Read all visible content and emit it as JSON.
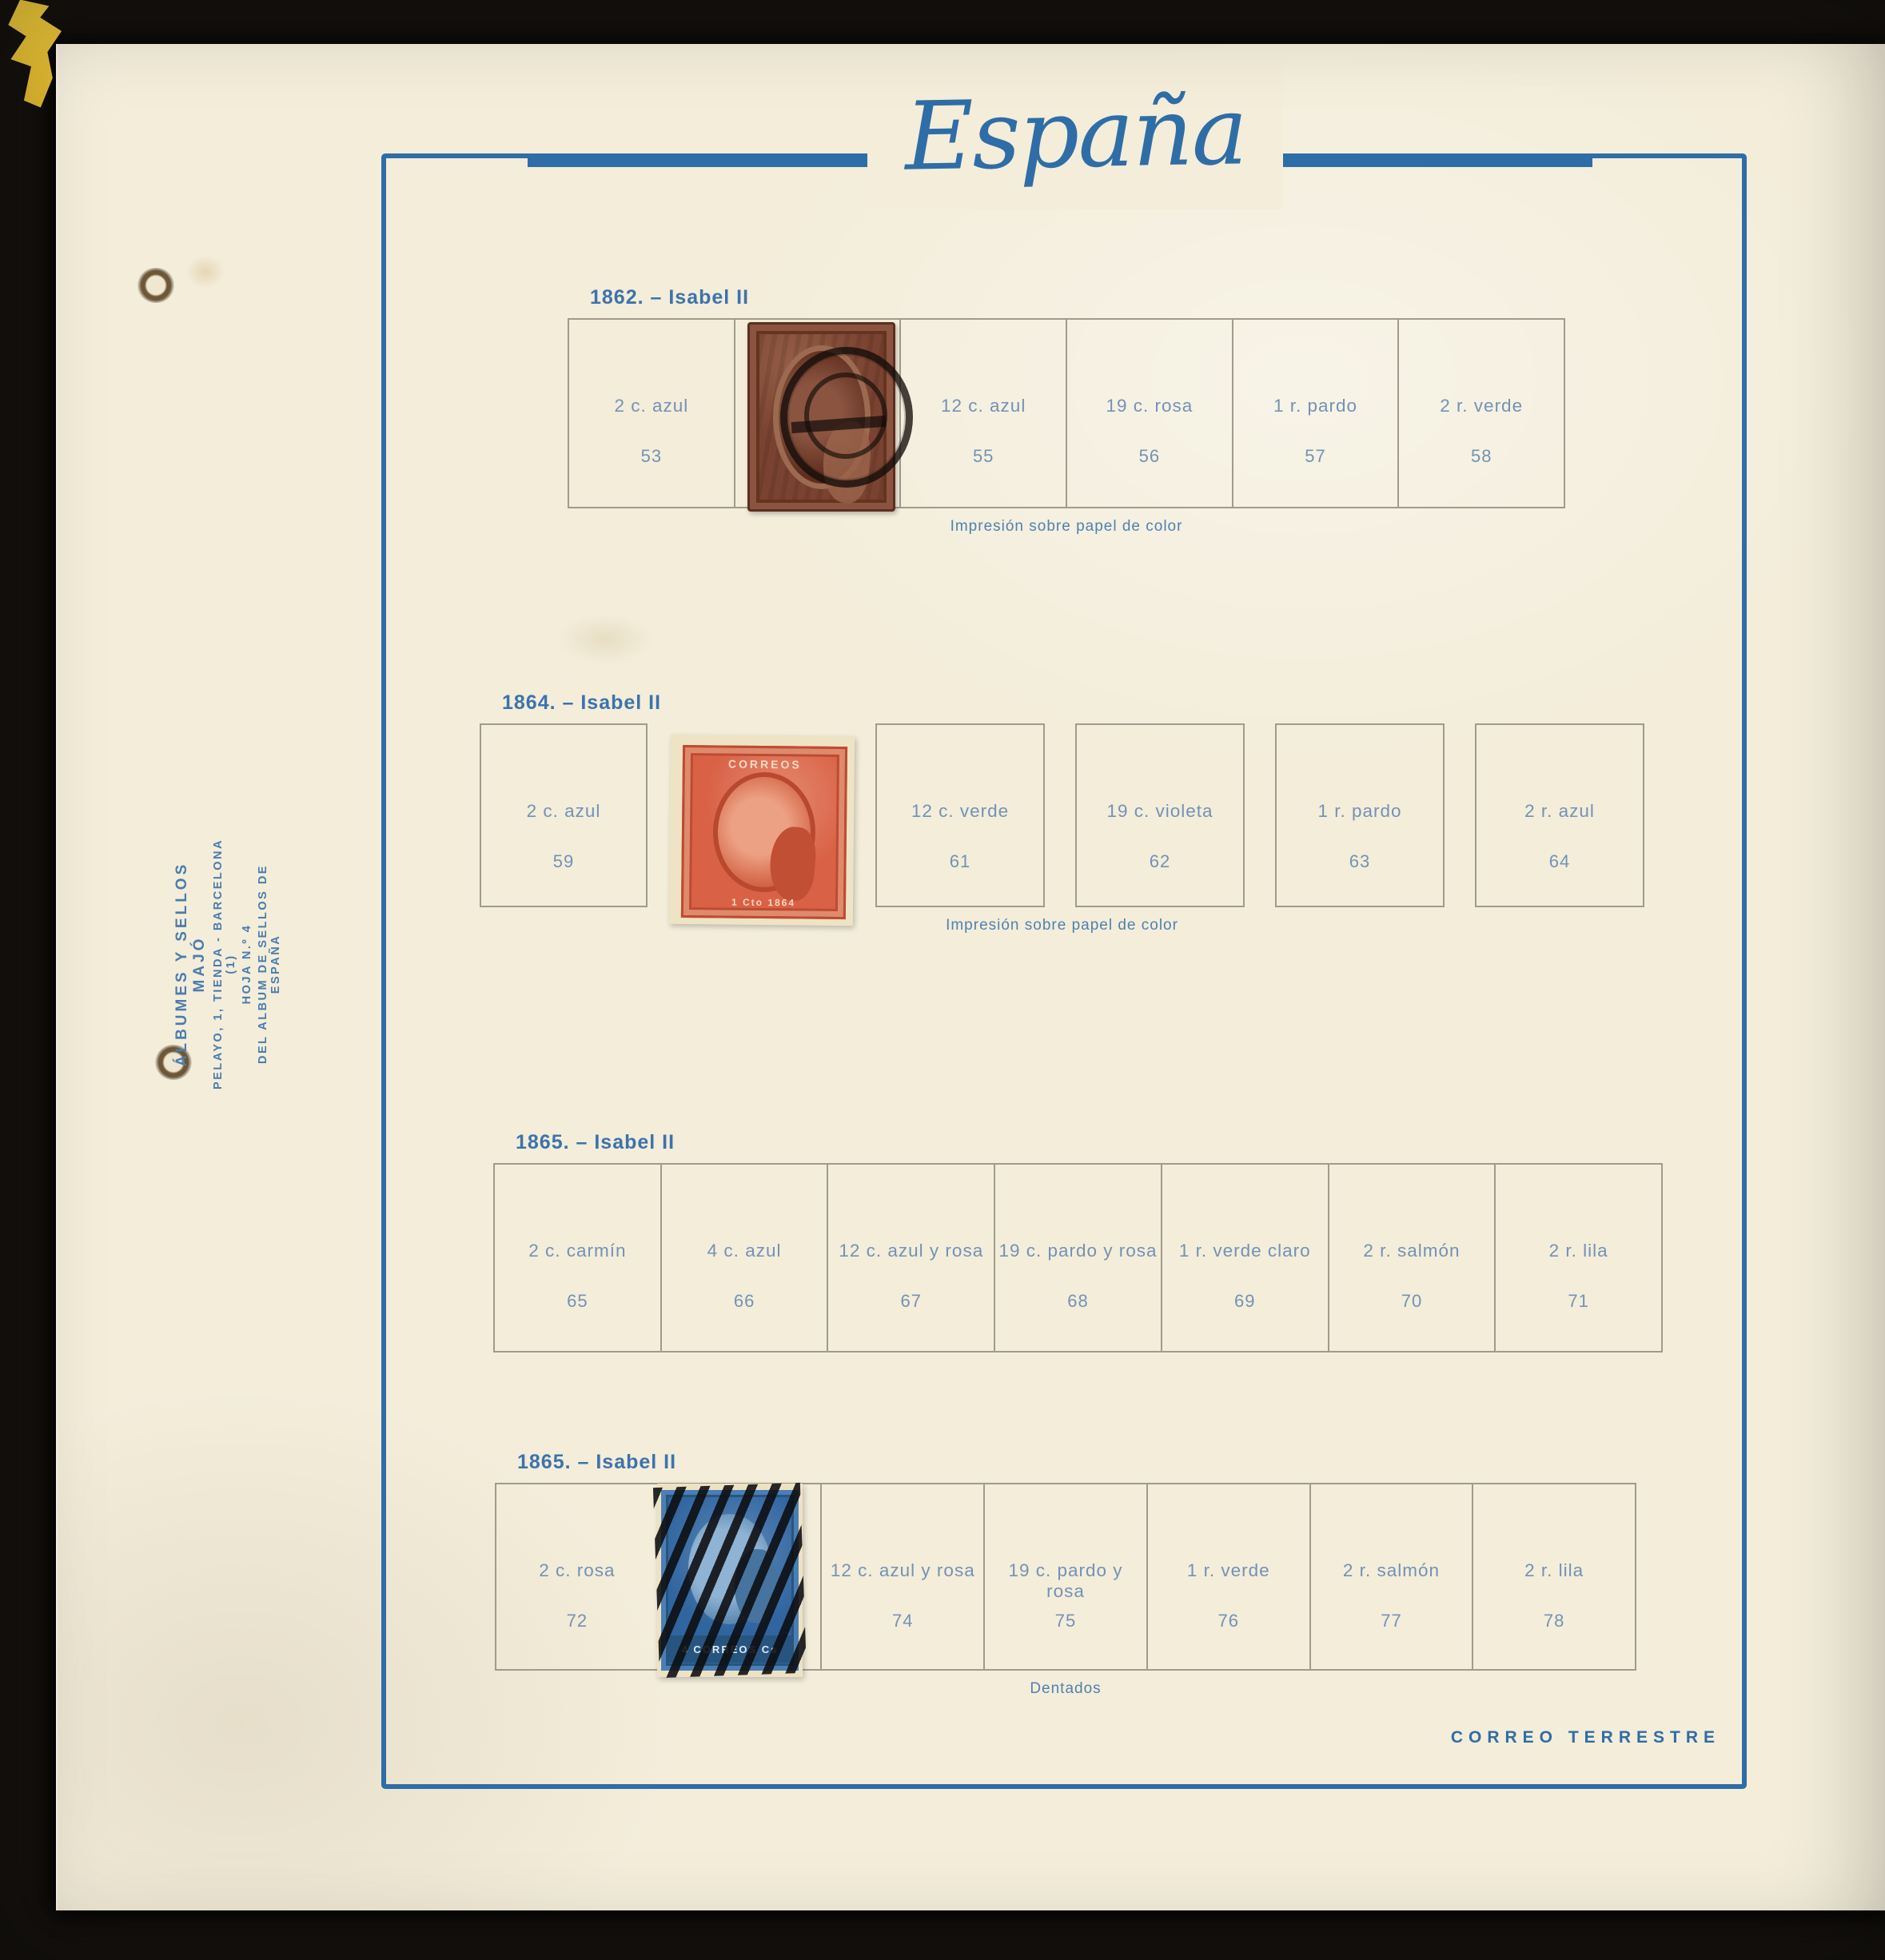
{
  "photo": {
    "background_color": "#14110e",
    "paper_color": "#f3edda",
    "accent_blue": "#2f6da6",
    "label_blue": "#7492b5",
    "grid_line_color": "#a19b8c"
  },
  "page_title": "España",
  "imprint": {
    "line1": "ÁLBUMES Y SELLOS MAJÓ",
    "line2": "PELAYO, 1, TIENDA - BARCELONA (1)",
    "line3": "HOJA N.º 4",
    "line4": "DEL ALBUM DE SELLOS DE ESPAÑA"
  },
  "footer": "CORREO TERRESTRE",
  "sections": [
    {
      "year_header": "1862. – Isabel II",
      "caption": "Impresión sobre papel de color",
      "cells": [
        {
          "label": "2 c. azul",
          "number": "53"
        },
        {
          "label": "",
          "number": "",
          "stamp": "sello-1862-pardo-matasellado"
        },
        {
          "label": "12 c. azul",
          "number": "55",
          "extra": "resto-papel-amarillo"
        },
        {
          "label": "19 c. rosa",
          "number": "56"
        },
        {
          "label": "1 r. pardo",
          "number": "57"
        },
        {
          "label": "2 r. verde",
          "number": "58"
        }
      ]
    },
    {
      "year_header": "1864. – Isabel II",
      "caption": "Impresión sobre papel de color",
      "cells": [
        {
          "label": "2 c. azul",
          "number": "59"
        },
        {
          "label": "",
          "number": "",
          "stamp": "sello-1864-rojo-nuevo"
        },
        {
          "label": "12 c. verde",
          "number": "61"
        },
        {
          "label": "19 c. violeta",
          "number": "62"
        },
        {
          "label": "1 r. pardo",
          "number": "63"
        },
        {
          "label": "2 r. azul",
          "number": "64"
        }
      ]
    },
    {
      "year_header": "1865. – Isabel II",
      "caption": "",
      "cells": [
        {
          "label": "2 c. carmín",
          "number": "65"
        },
        {
          "label": "4 c. azul",
          "number": "66"
        },
        {
          "label": "12 c. azul y rosa",
          "number": "67"
        },
        {
          "label": "19 c. pardo y rosa",
          "number": "68"
        },
        {
          "label": "1 r. verde claro",
          "number": "69"
        },
        {
          "label": "2 r. salmón",
          "number": "70"
        },
        {
          "label": "2 r. lila",
          "number": "71"
        }
      ]
    },
    {
      "year_header": "1865. – Isabel II",
      "caption": "Dentados",
      "cells": [
        {
          "label": "2 c. rosa",
          "number": "72"
        },
        {
          "label": "",
          "number": "",
          "stamp": "sello-1865-azul-parrilla"
        },
        {
          "label": "12 c. azul y rosa",
          "number": "74"
        },
        {
          "label": "19 c. pardo y rosa",
          "number": "75"
        },
        {
          "label": "1 r. verde",
          "number": "76"
        },
        {
          "label": "2 r. salmón",
          "number": "77"
        },
        {
          "label": "2 r. lila",
          "number": "78"
        }
      ]
    }
  ],
  "stamps": {
    "s1864": {
      "top_text": "CORREOS",
      "bottom_text": "1 Cto 1864"
    },
    "s1865": {
      "bottom_text": "4 CORREOS Cs"
    }
  }
}
